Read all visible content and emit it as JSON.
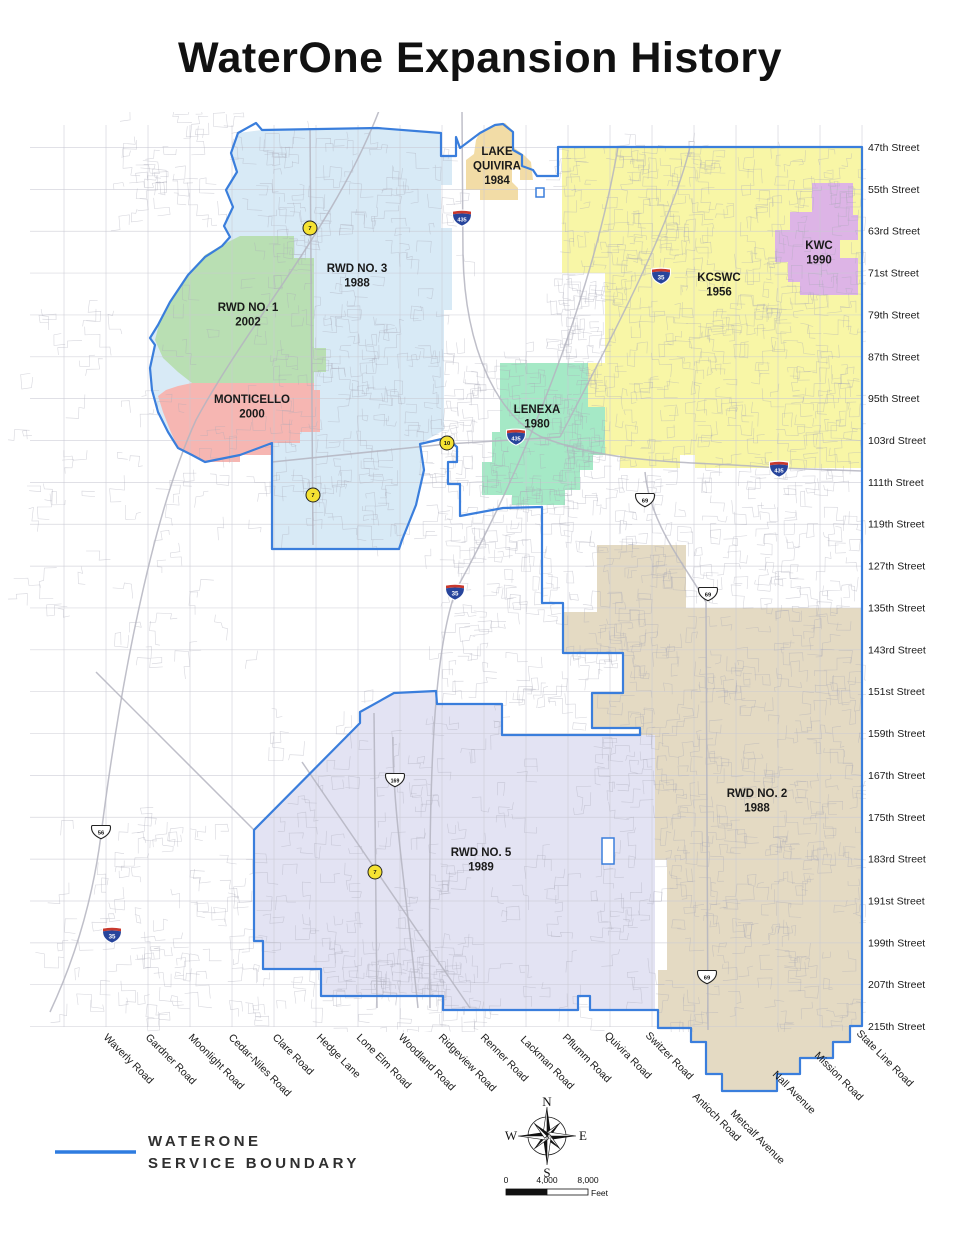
{
  "title": "WaterOne Expansion History",
  "legend": {
    "line1": "WATERONE",
    "line2": "SERVICE BOUNDARY",
    "boundary_color": "#2e7ce0"
  },
  "compass": {
    "n": "N",
    "e": "E",
    "s": "S",
    "w": "W"
  },
  "scalebar": {
    "t0": "0",
    "t1": "4,000",
    "t2": "8,000",
    "unit": "Feet"
  },
  "map": {
    "colors": {
      "boundary": "#3a7edc",
      "grid": "#c9c9d3",
      "road": "#a9a9b8",
      "highway": "#b4b4bf",
      "label": "#1a1a1a"
    },
    "regions": [
      {
        "name": "RWD NO. 3",
        "year": "1988",
        "color": "#D8EAF6",
        "label_x": 357,
        "label_y": 272,
        "label_lines": [
          "RWD NO. 3",
          "1988"
        ],
        "points": "238,133 262,130 377,128 441,133 441,156 452,156 452,185 441,185 441,228 452,228 452,310 444,310 444,430 420,444 424,470 416,505 402,540 399,549 272,549 272,443 240,455 205,462 192,455 178,448 168,432 158,412 152,390 150,368 155,345 150,338 158,325 170,302 188,275 205,257 222,246 230,237 224,226 233,207 226,190 237,172 231,153"
      },
      {
        "name": "KCSWC",
        "year": "1956",
        "color": "#F8F6A6",
        "label_x": 719,
        "label_y": 281,
        "label_lines": [
          "KCSWC",
          "1956"
        ],
        "points": "562,147 862,147 862,468 695,468 695,455 680,455 680,468 620,468 620,455 605,455 605,407 588,407 588,363 605,363 605,273 562,273"
      },
      {
        "name": "RWD NO. 2",
        "year": "1988",
        "color": "#E4DAC3",
        "label_x": 757,
        "label_y": 797,
        "label_lines": [
          "RWD NO. 2",
          "1988"
        ],
        "points": "597,545 686,545 686,608 862,608 862,1026 850,1026 850,1042 833,1042 833,1058 800,1058 800,1074 777,1074 777,1091 722,1091 722,1074 706,1074 706,1042 691,1042 691,1028 658,1028 658,970 667,970 667,860 653,860 653,735 640,735 640,728 592,728 592,693 623,693 623,653 563,653 563,612 597,612"
      },
      {
        "name": "RWD NO. 5",
        "year": "1989",
        "color": "#E3E3F3",
        "label_x": 481,
        "label_y": 856,
        "label_lines": [
          "RWD NO. 5",
          "1989"
        ],
        "points": "394,693 436,691 437,704 502,704 502,735 655,735 655,1010 590,1010 590,996 578,996 578,1010 443,1010 443,996 321,996 321,969 263,969 263,941 254,941 254,830 330,753 360,723 360,712"
      },
      {
        "name": "RWD NO. 1",
        "year": "2002",
        "color": "#B9DFB3",
        "label_x": 248,
        "label_y": 311,
        "label_lines": [
          "RWD NO. 1",
          "2002"
        ],
        "points": "240,236 294,236 294,258 314,258 314,348 326,348 326,372 314,372 314,383 192,383 178,372 163,358 155,340 160,320 172,298 190,272 205,255 222,245"
      },
      {
        "name": "MONTICELLO",
        "year": "2000",
        "color": "#F6B6B2",
        "label_x": 252,
        "label_y": 403,
        "label_lines": [
          "MONTICELLO",
          "2000"
        ],
        "points": "192,383 314,383 314,390 320,390 320,432 300,432 300,443 272,443 272,455 240,455 240,462 205,462 192,455 178,448 170,430 163,412 158,396 166,390 178,386"
      },
      {
        "name": "LAKE QUIVIRA",
        "year": "1984",
        "color": "#F2DCA6",
        "label_x": 497,
        "label_y": 155,
        "label_lines": [
          "LAKE",
          "QUIVIRA",
          "1984"
        ],
        "points": "480,132 495,124 505,123 513,131 513,147 524,155 531,162 533,180 520,180 520,170 512,168 512,182 518,188 518,200 480,200 480,190 466,190 466,160 474,154 476,140"
      },
      {
        "name": "KWC",
        "year": "1990",
        "color": "#DDB4E6",
        "label_x": 819,
        "label_y": 249,
        "label_lines": [
          "KWC",
          "1990"
        ],
        "points": "812,183 853,183 853,215 858,215 858,240 840,240 840,258 858,258 858,295 800,295 800,282 788,282 788,262 775,262 775,230 790,230 790,212 812,212"
      },
      {
        "name": "LENEXA",
        "year": "1980",
        "color": "#A5E9C6",
        "label_x": 537,
        "label_y": 413,
        "label_lines": [
          "LENEXA",
          "1980"
        ],
        "points": "500,363 588,363 588,407 605,407 605,455 593,455 593,470 580,470 580,490 565,490 565,505 512,505 512,495 482,495 482,462 492,462 492,432 500,432"
      }
    ],
    "boundary_path": "M420,444 L446,438 L457,447 L457,462 L448,462 L448,484 L460,484 L460,516 L503,508 L542,507 L542,603 L563,603 L563,653 L623,653 L623,693 L592,693 L592,728 L640,728 L640,735 L502,735 L502,704 L437,704 L436,691 L394,693 L360,712 L360,723 L254,830 L254,941 L263,941 L263,969 L321,969 L321,996 L443,996 L443,1010 L578,1010 L578,996 L590,996 L590,1010 L658,1010 L658,1028 L691,1028 L691,1042 L706,1042 L706,1074 L722,1074 L722,1091 L777,1091 L777,1074 L800,1074 L800,1058 L833,1058 L833,1042 L850,1042 L850,1026 L862,1026 L862,147 L558,147 L558,176 L537,176 L533,170 L522,166 L522,155 L513,150 L513,132 L503,124 L495,125 L480,133 L460,148 L456,137 L456,156 L441,156 L441,133 L377,128 L262,130 L256,123 L238,133 L231,153 L237,172 L226,190 L233,207 L224,226 L230,237 L222,246 L205,257 L188,275 L170,302 L158,325 L150,338 L155,345 L150,368 L152,390 L158,412 L168,432 L178,448 L192,455 L205,462 L240,455 L272,443 L272,549 L399,549 L402,540 L416,505 L424,470 Z",
    "cutouts": [
      {
        "x": 602,
        "y": 838,
        "w": 12,
        "h": 26
      },
      {
        "x": 536,
        "y": 188,
        "w": 8,
        "h": 9
      }
    ],
    "shields": [
      {
        "type": "interstate",
        "num": "435",
        "x": 462,
        "y": 218
      },
      {
        "type": "interstate",
        "num": "35",
        "x": 661,
        "y": 276
      },
      {
        "type": "interstate",
        "num": "435",
        "x": 516,
        "y": 437
      },
      {
        "type": "interstate",
        "num": "435",
        "x": 779,
        "y": 469
      },
      {
        "type": "interstate",
        "num": "35",
        "x": 455,
        "y": 592
      },
      {
        "type": "interstate",
        "num": "35",
        "x": 112,
        "y": 935
      },
      {
        "type": "us",
        "num": "69",
        "x": 645,
        "y": 500
      },
      {
        "type": "us",
        "num": "69",
        "x": 708,
        "y": 594
      },
      {
        "type": "us",
        "num": "69",
        "x": 707,
        "y": 977
      },
      {
        "type": "us",
        "num": "56",
        "x": 101,
        "y": 832
      },
      {
        "type": "us",
        "num": "169",
        "x": 395,
        "y": 780
      },
      {
        "type": "state",
        "num": "7",
        "x": 310,
        "y": 228
      },
      {
        "type": "state",
        "num": "7",
        "x": 313,
        "y": 495
      },
      {
        "type": "state",
        "num": "7",
        "x": 375,
        "y": 872
      },
      {
        "type": "state",
        "num": "10",
        "x": 447,
        "y": 443
      }
    ],
    "street_labels": [
      "47th Street",
      "55th Street",
      "63rd Street",
      "71st Street",
      "79th Street",
      "87th Street",
      "95th Street",
      "103rd Street",
      "111th Street",
      "119th Street",
      "127th Street",
      "135th Street",
      "143rd Street",
      "151st Street",
      "159th Street",
      "167th Street",
      "175th Street",
      "183rd Street",
      "191st Street",
      "199th Street",
      "207th Street",
      "215th Street"
    ],
    "road_labels": [
      {
        "name": "Waverly Road",
        "x": 103,
        "y": 1038
      },
      {
        "name": "Gardner Road",
        "x": 145,
        "y": 1038
      },
      {
        "name": "Moonlight Road",
        "x": 188,
        "y": 1038
      },
      {
        "name": "Cedar-Niles Road",
        "x": 228,
        "y": 1038
      },
      {
        "name": "Clare Road",
        "x": 272,
        "y": 1038
      },
      {
        "name": "Hedge Lane",
        "x": 316,
        "y": 1038
      },
      {
        "name": "Lone Elm Road",
        "x": 356,
        "y": 1038
      },
      {
        "name": "Woodland Road",
        "x": 398,
        "y": 1038
      },
      {
        "name": "Ridgeview Road",
        "x": 438,
        "y": 1038
      },
      {
        "name": "Renner Road",
        "x": 480,
        "y": 1038
      },
      {
        "name": "Lackman Road",
        "x": 520,
        "y": 1040
      },
      {
        "name": "Pflumm Road",
        "x": 562,
        "y": 1038
      },
      {
        "name": "Quivira Road",
        "x": 604,
        "y": 1036
      },
      {
        "name": "Switzer Road",
        "x": 645,
        "y": 1036
      },
      {
        "name": "Antioch Road",
        "x": 692,
        "y": 1097
      },
      {
        "name": "Metcalf Avenue",
        "x": 730,
        "y": 1114
      },
      {
        "name": "Nall Avenue",
        "x": 772,
        "y": 1075
      },
      {
        "name": "Mission Road",
        "x": 814,
        "y": 1056
      },
      {
        "name": "State Line Road",
        "x": 856,
        "y": 1034
      }
    ],
    "highways": [
      "M383,100 C340,220 250,320 196,420 C150,520 118,700 101,835 C92,905 72,965 50,1012",
      "M618,147 C592,300 522,470 456,590 C432,655 428,790 430,1008",
      "M462,112 L463,255 C465,350 498,418 544,438 C618,466 700,461 779,468 L862,471",
      "M645,472 C650,525 685,565 706,602 L708,1030",
      "M393,737 C392,805 406,890 418,1008",
      "M310,128 L313,545",
      "M374,713 L377,1008",
      "M272,462 L447,444 L560,437",
      "M302,762 L470,1008",
      "M690,147 C670,230 600,360 560,437",
      "M96,672 L254,830"
    ]
  }
}
